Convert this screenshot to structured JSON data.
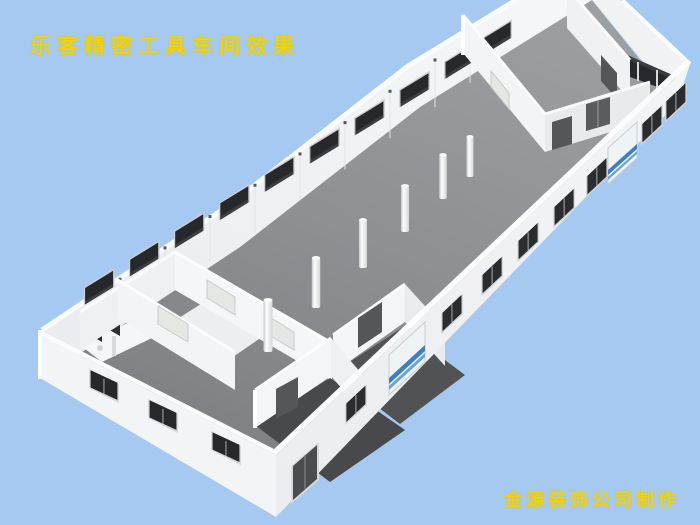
{
  "title": {
    "text": "乐客精密工具车间效果"
  },
  "credit": {
    "text": "金源装饰公司制作"
  },
  "colors": {
    "background": "#a6c9f1",
    "title_text": "#f2d400",
    "wall_white": "#f2f4f6",
    "wall_shaded": "#e6e8ea",
    "wall_top_edge": "#fbfcfd",
    "floor_gray_near": "#7e8082",
    "floor_gray_far": "#9b9da0",
    "dark_room_floor": "#4b4d4f",
    "window_dark": "#26282b",
    "door_dark": "#54575a",
    "frosted_glass": "#e3e8e4",
    "roller_door_stripe": "#3d7fc4"
  },
  "scene": {
    "type": "3d-architectural-rendering",
    "subject": "roofless perspective view of a precision-tool factory workshop",
    "columns_count": 6,
    "nw_wall_window_count": 10,
    "sw_wall_window_count": 3,
    "se_wall_window_count": 8,
    "se_roller_door_count": 2,
    "se_double_door_count": 1,
    "ne_window_pane_count": 4,
    "room_clusters": [
      "office-and-restroom cluster at lower-left corner",
      "two dark-floor rooms along lower edge",
      "office wing with clerestory window band at upper-right corner"
    ]
  }
}
